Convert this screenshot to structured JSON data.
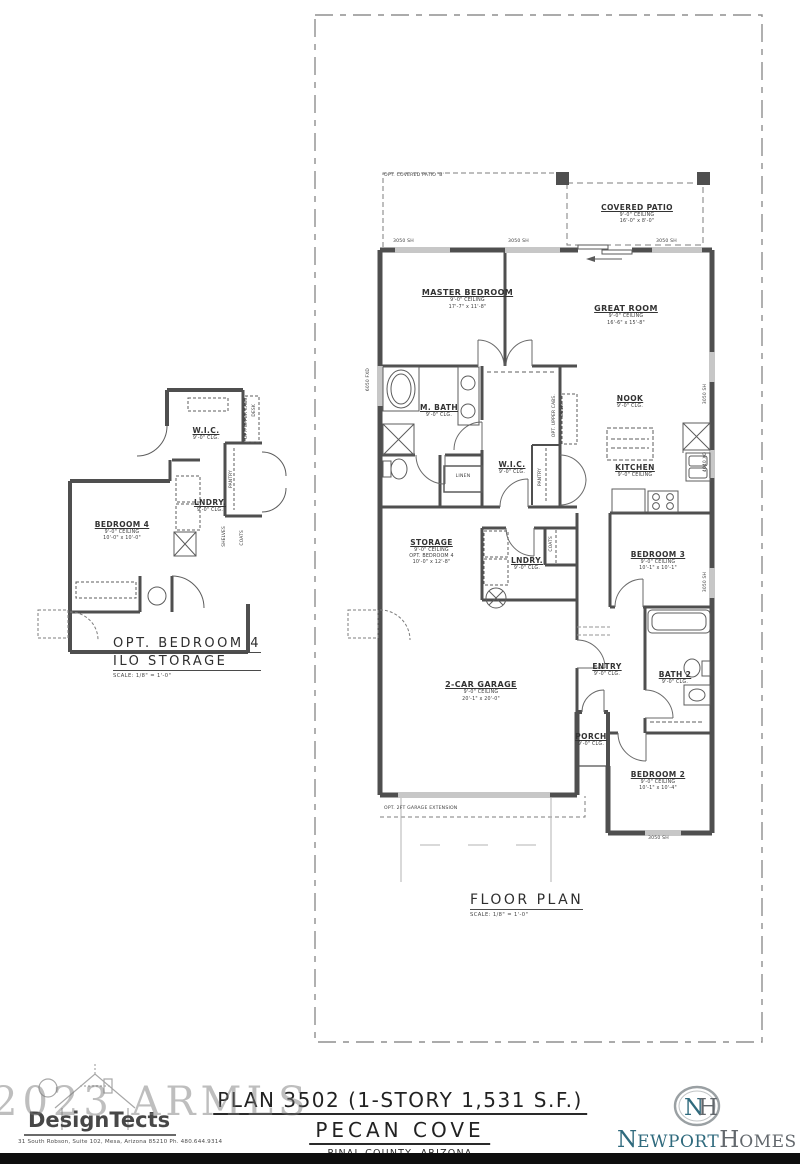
{
  "sheet": {
    "floor_plan_title": "FLOOR PLAN",
    "floor_plan_scale": "SCALE: 1/8\" = 1'-0\"",
    "alt_plan_title_line1": "OPT. BEDROOM 4",
    "alt_plan_title_line2": "ILO STORAGE",
    "alt_plan_scale": "SCALE: 1/8\" = 1'-0\""
  },
  "rooms": {
    "covered_patio": {
      "name": "COVERED PATIO",
      "ceiling": "9'-0\" CEILING",
      "size": "16'-0\" x 8'-0\""
    },
    "master_bedroom": {
      "name": "MASTER BEDROOM",
      "ceiling": "9'-0\" CEILING",
      "size": "17'-7\" x 11'-8\""
    },
    "great_room": {
      "name": "GREAT ROOM",
      "ceiling": "9'-0\" CEILING",
      "size": "16'-6\" x 15'-8\""
    },
    "nook": {
      "name": "NOOK",
      "ceiling": "9'-0\" CLG."
    },
    "kitchen": {
      "name": "KITCHEN",
      "ceiling": "9'-0\" CEILING"
    },
    "m_bath": {
      "name": "M. BATH",
      "ceiling": "9'-0\" CLG."
    },
    "wic": {
      "name": "W.I.C.",
      "ceiling": "9'-0\" CLG."
    },
    "storage": {
      "name": "STORAGE",
      "ceiling": "9'-0\" CEILING",
      "note": "OPT. BEDROOM 4",
      "size": "10'-0\" x 12'-8\""
    },
    "laundry": {
      "name": "LNDRY.",
      "ceiling": "9'-0\" CLG."
    },
    "bedroom3": {
      "name": "BEDROOM 3",
      "ceiling": "9'-0\" CEILING",
      "size": "10'-1\" x 10'-1\""
    },
    "entry": {
      "name": "ENTRY",
      "ceiling": "9'-0\" CLG."
    },
    "bath2": {
      "name": "BATH 2",
      "ceiling": "9'-0\" CLG."
    },
    "garage": {
      "name": "2-CAR GARAGE",
      "ceiling": "9'-0\" CEILING",
      "size": "20'-1\" x 20'-0\""
    },
    "porch": {
      "name": "PORCH",
      "ceiling": "9'-0\" CLG."
    },
    "bedroom2": {
      "name": "BEDROOM 2",
      "ceiling": "9'-0\" CEILING",
      "size": "10'-1\" x 10'-4\""
    },
    "alt_bedroom4": {
      "name": "BEDROOM 4",
      "ceiling": "9'-0\" CEILING",
      "size": "10'-0\" x 10'-0\""
    },
    "alt_wic": {
      "name": "W.I.C.",
      "ceiling": "9'-0\" CLG."
    },
    "alt_laundry": {
      "name": "LNDRY.",
      "ceiling": "9'-0\" CLG."
    }
  },
  "annotations": {
    "opt_covered_patio": "OPT. COVERED PATIO 'B'",
    "opt_garage_extension": "OPT. 2FT GARAGE EXTENSION",
    "linen": "LINEN",
    "pantry": "PANTRY",
    "coats": "COATS",
    "shelves": "SHELVES",
    "opt_upper_cabs": "OPT. UPPER CABS.",
    "desk": "DESK",
    "window_3050": "3050 SH",
    "window_4040": "4040 XO",
    "window_6050": "6050 FXD"
  },
  "footer": {
    "plan_title": "PLAN 3502 (1-STORY 1,531 S.F.)",
    "community": "PECAN COVE",
    "location": "PINAL COUNTY, ARIZONA",
    "watermark": "2023 ARMLS",
    "architect_name": "DesignTects",
    "architect_address": "31 South Robson, Suite 102, Mesa, Arizona 85210   Ph. 480.644.9314",
    "builder_initial1": "N",
    "builder_rest1": "EWPORT",
    "builder_initial2": "H",
    "builder_rest2": "OMES",
    "monogram_n": "N",
    "monogram_h": "H"
  },
  "colors": {
    "wall": "#4f4f4f",
    "builder_teal": "#2f6a7d",
    "builder_gray": "#63686d"
  }
}
